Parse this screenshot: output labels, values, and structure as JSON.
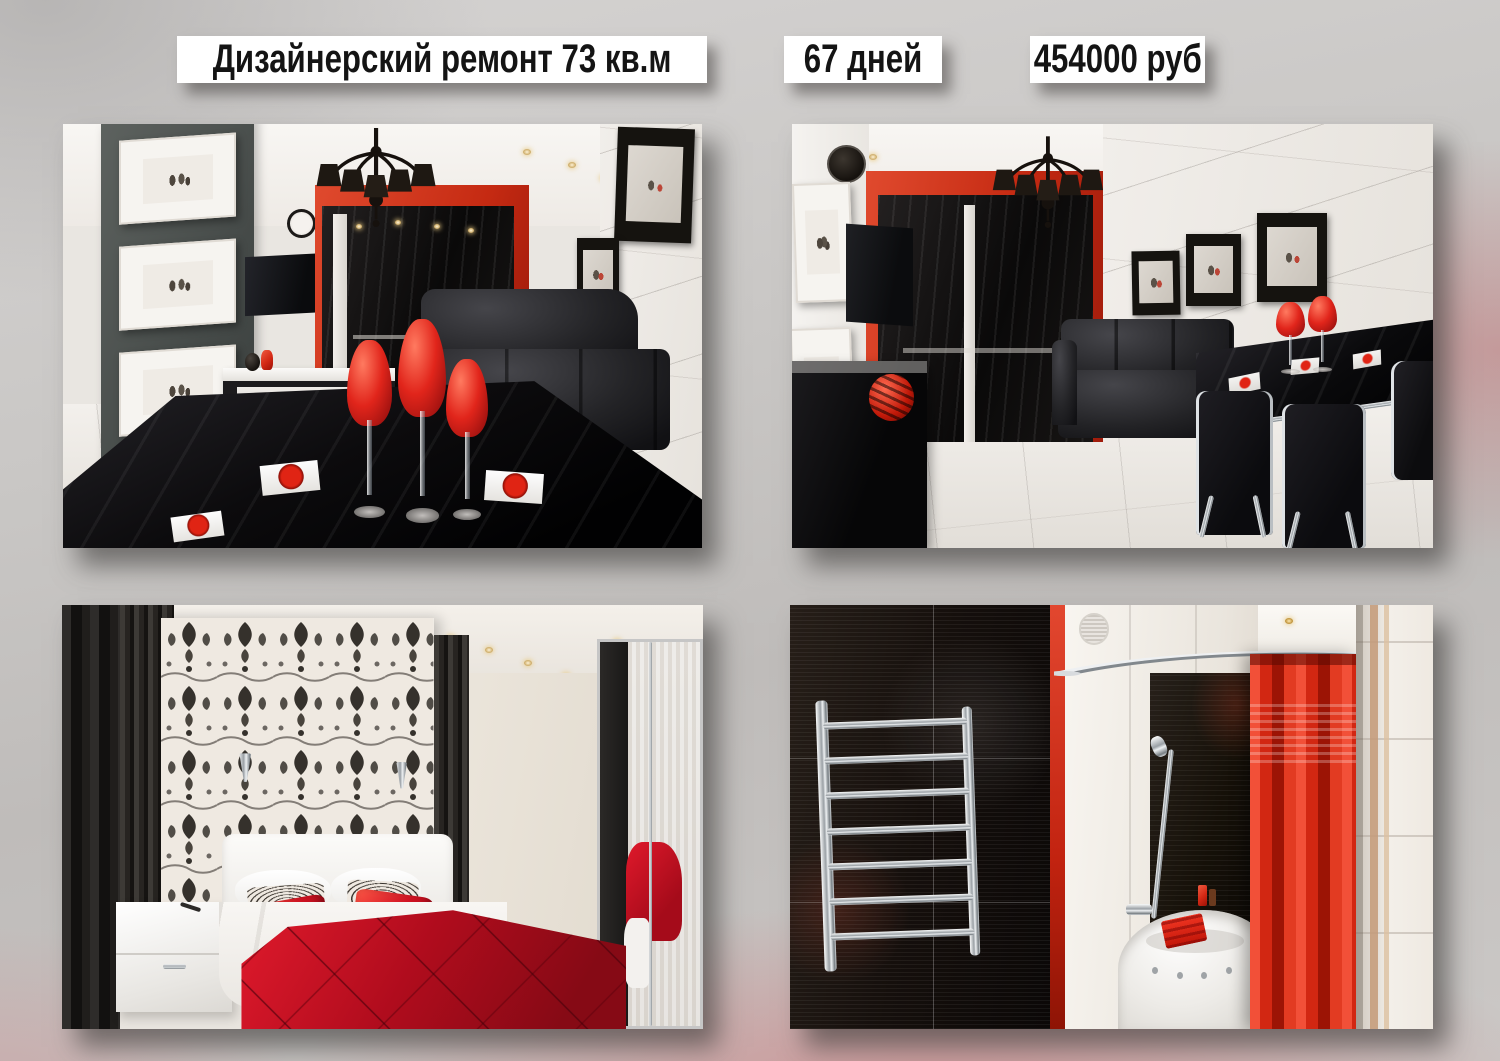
{
  "header": {
    "title": "Дизайнерский ремонт 73 кв.м",
    "duration": "67 дней",
    "price": "454000 руб"
  },
  "photos": [
    {
      "name": "living-room-dining",
      "caption": "Living room: black glossy dining table with red goblets, red-framed black kitchen niche, grey panel with black-and-white pictures, black chandelier"
    },
    {
      "name": "living-room-sofa",
      "caption": "Living room: black leather sofa, white marble wall with framed photos, black dining table with red goblets and chrome chairs"
    },
    {
      "name": "bedroom",
      "caption": "Bedroom: black-and-white damask wallpaper, white bed with red velvet bedspread and red pillows, white nightstand, mirrored wardrobe"
    },
    {
      "name": "bathroom",
      "caption": "Bathroom: glossy black tiles, chrome towel ladder, corner white bath with red towel, red shower curtain on curved rail"
    }
  ],
  "colors": {
    "accent_red": "#d92b18",
    "velvet_red": "#b00c1d",
    "label_background": "#ffffff",
    "label_text": "#141414",
    "background_gray": "#c7c5c3",
    "background_pink": "#cd8083",
    "photo_shadow": "rgba(52,50,48,0.58)"
  }
}
